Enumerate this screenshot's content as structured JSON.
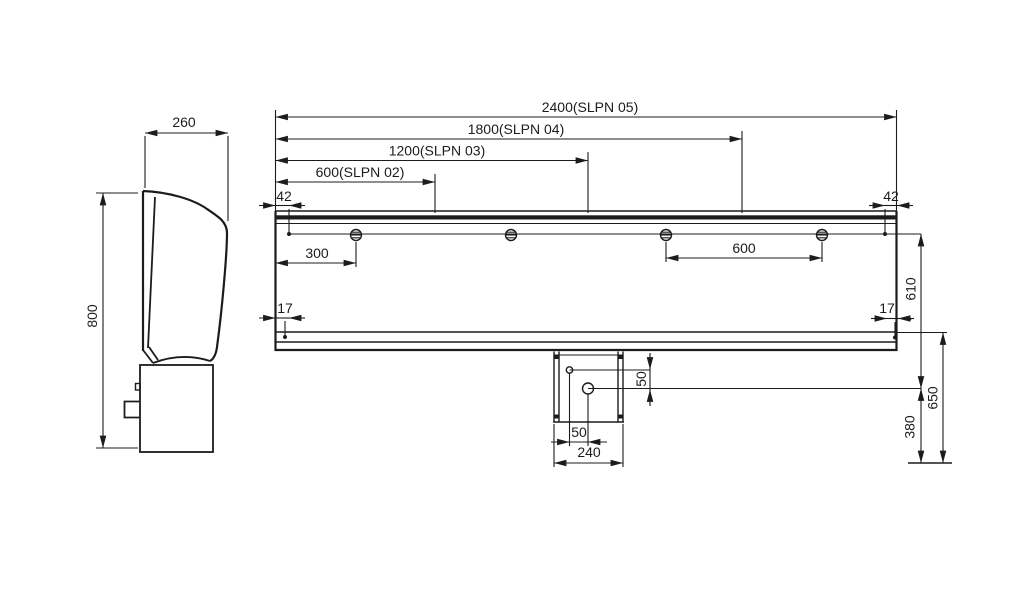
{
  "drawing": {
    "colors": {
      "line": "#1c1c1c",
      "background": "#ffffff"
    },
    "side_view": {
      "depth": "260",
      "height": "800"
    },
    "front_view": {
      "length_dims": [
        {
          "label": "600(SLPN 02)"
        },
        {
          "label": "1200(SLPN 03)"
        },
        {
          "label": "1800(SLPN 04)"
        },
        {
          "label": "2400(SLPN 05)"
        }
      ],
      "top_edge_offset_left": "42",
      "top_edge_offset_right": "42",
      "bottom_edge_offset_left": "17",
      "bottom_edge_offset_right": "17",
      "first_fixing_offset": "300",
      "fixing_spacing": "600",
      "fixing_line_to_outlet": "610",
      "bottom_rim_to_ref": "650",
      "outlet_to_ref": "380"
    },
    "drain_box": {
      "width": "240",
      "outlet_offset_horizontal": "50",
      "outlet_offset_vertical": "50"
    }
  }
}
